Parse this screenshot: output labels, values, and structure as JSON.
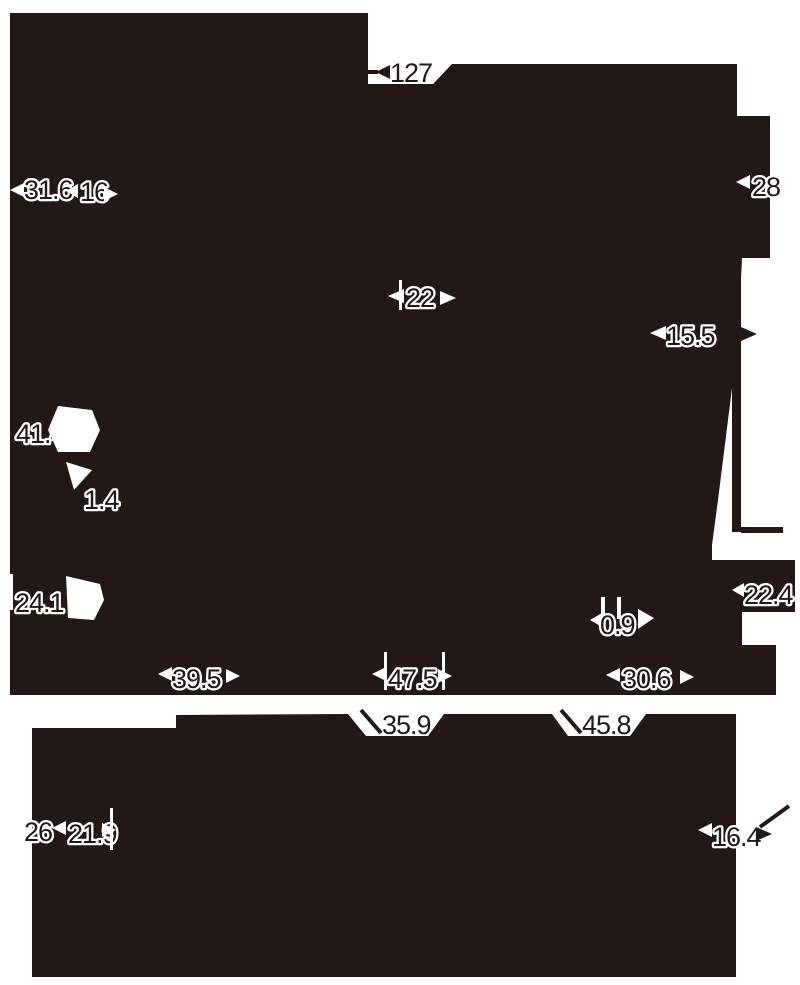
{
  "drawing": {
    "type": "product-dimension-diagram",
    "colors": {
      "ink": "#231815",
      "background": "#ffffff"
    },
    "views": {
      "top_view": "upper-silhouette",
      "side_view": "lower-silhouette"
    }
  },
  "dims": {
    "d127": "127",
    "d31_6": "31.6",
    "d16": "16",
    "d28": "28",
    "d22": "22",
    "d15_5": "15.5",
    "d41_4": "41.4",
    "d1_4": "1.4",
    "d24_1": "24.1",
    "d0_9": "0.9",
    "d22_4": "22.4",
    "d39_5": "39.5",
    "d47_5": "47.5",
    "d30_6": "30.6",
    "d35_9": "35.9",
    "d45_8": "45.8",
    "d26": "26",
    "d21_9": "21.9",
    "d16_4": "16.4"
  }
}
